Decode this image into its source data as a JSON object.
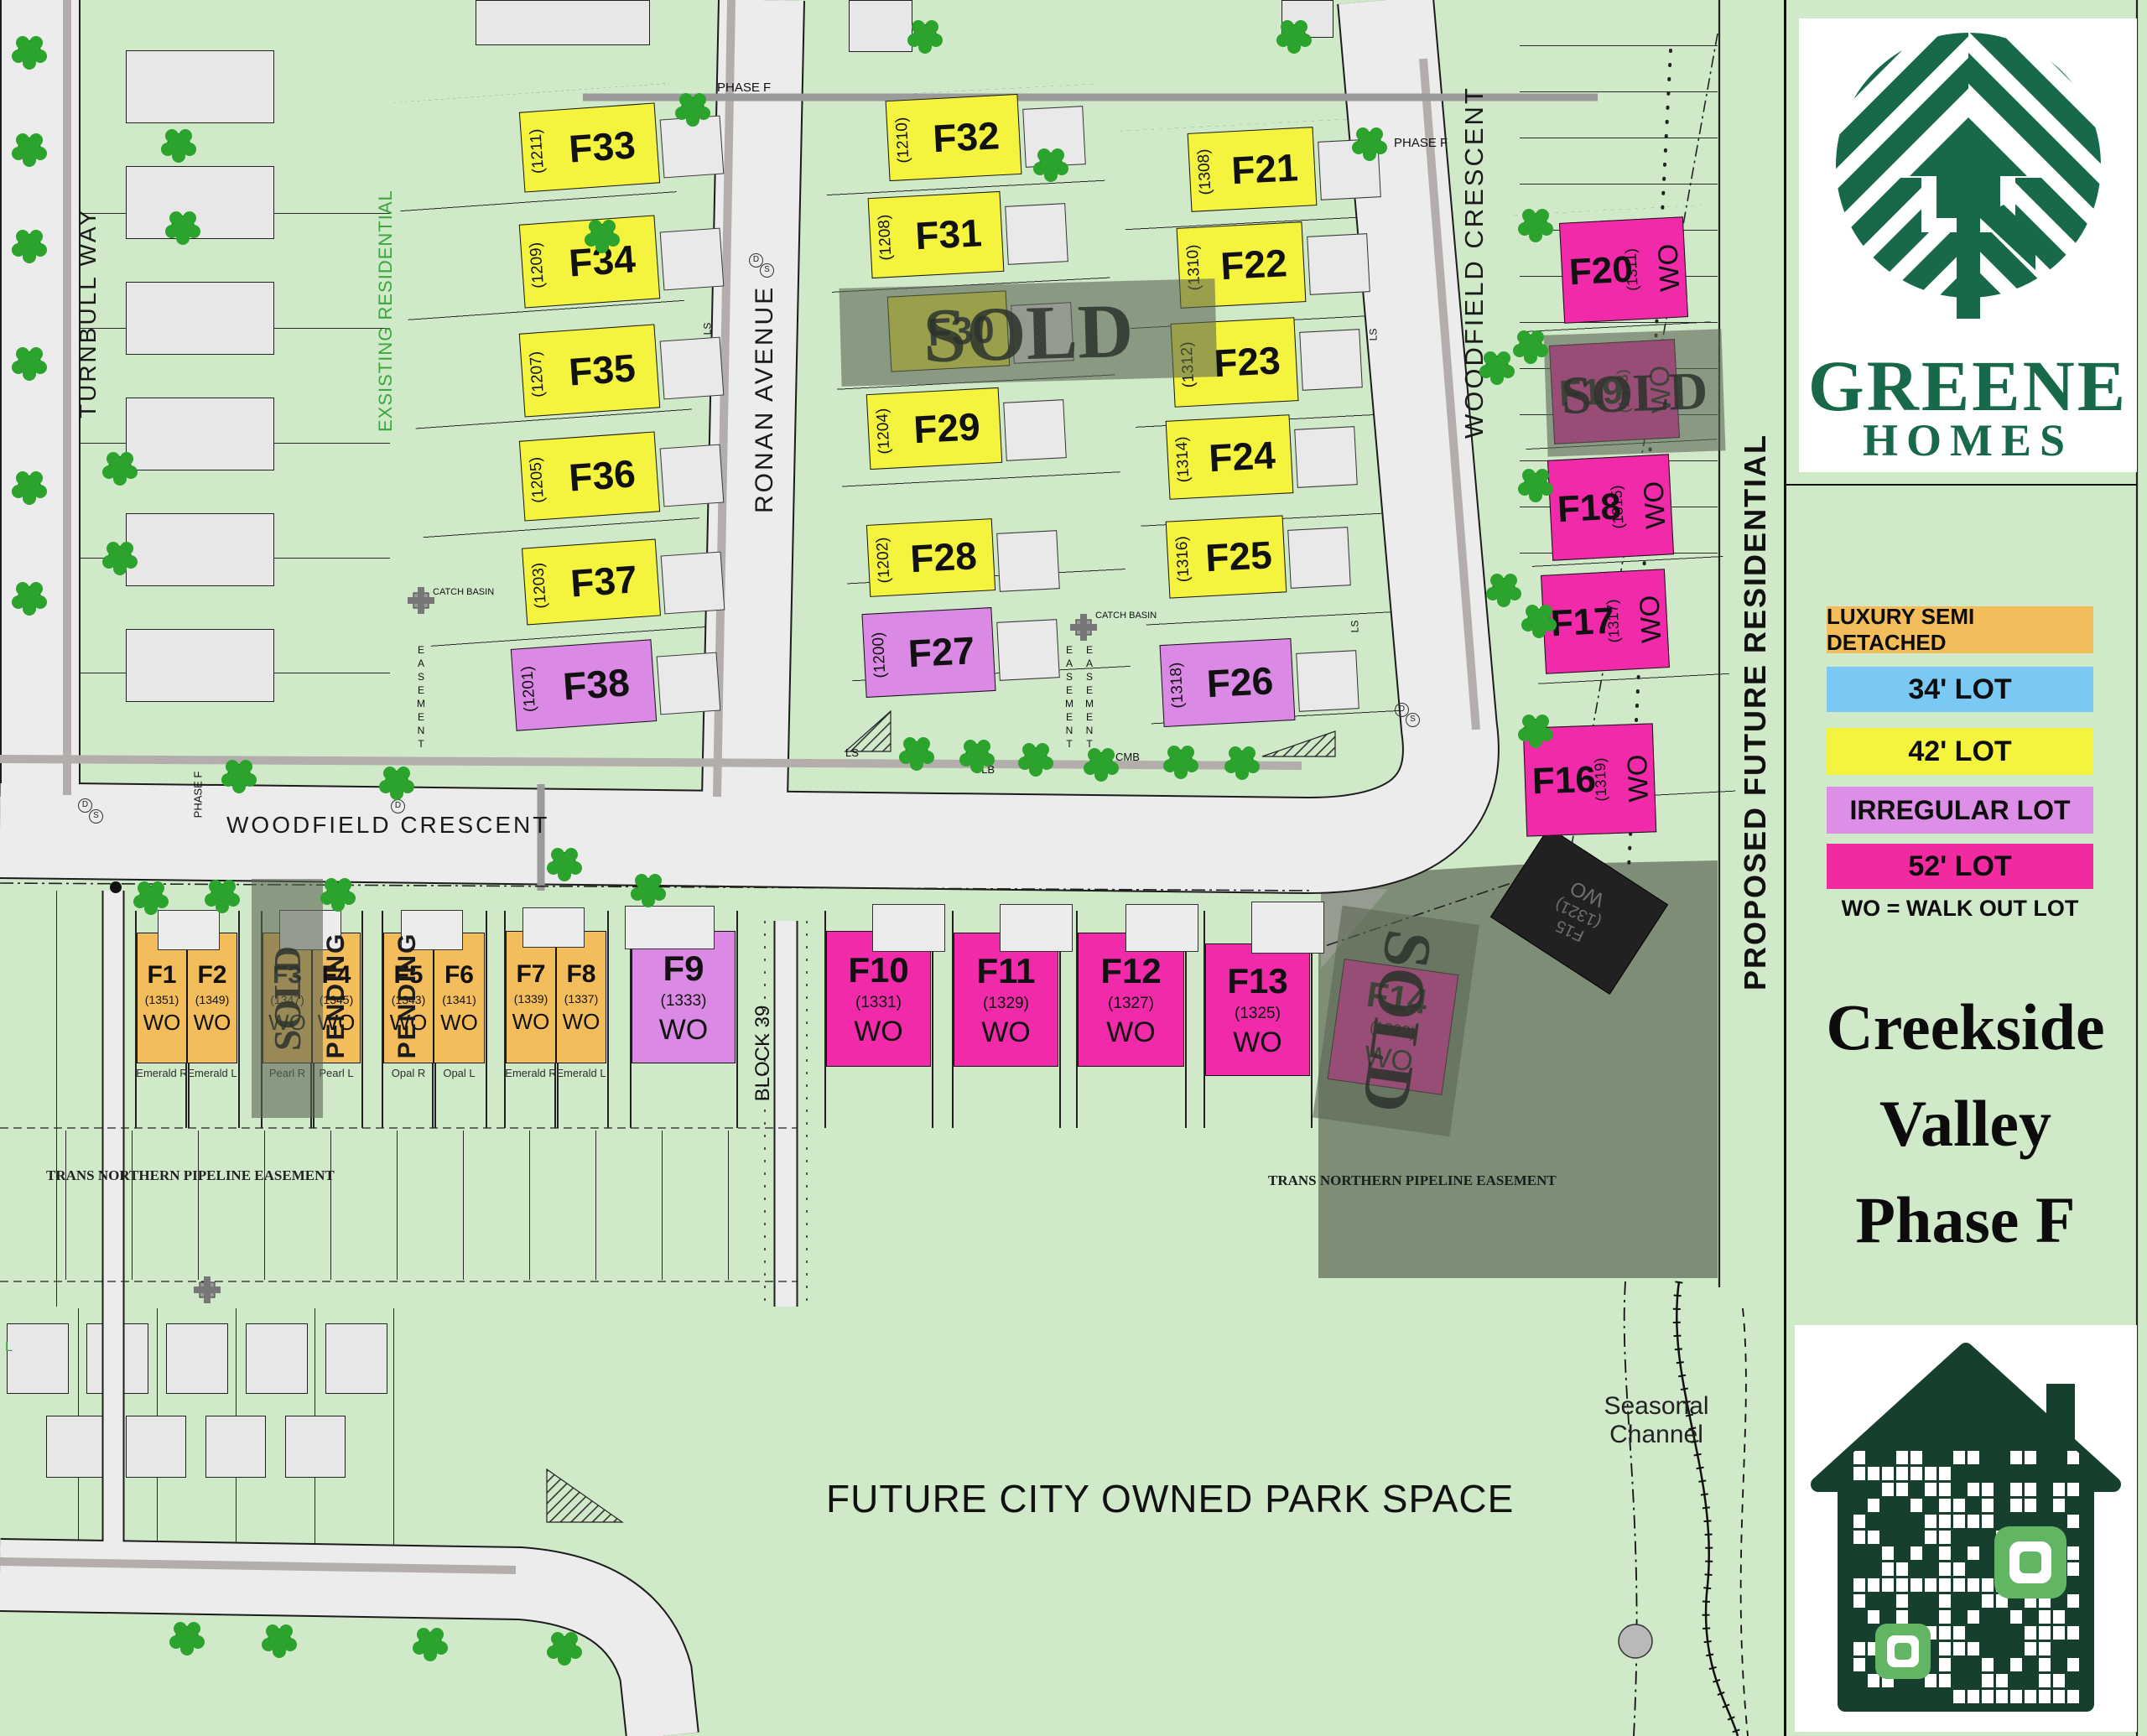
{
  "map": {
    "streets": {
      "turnbull": "TURNBULL WAY",
      "ronan": "RONAN AVENUE",
      "woodfield_bottom": "WOODFIELD CRESCENT",
      "woodfield_side": "WOODFIELD CRESCENT"
    },
    "labels": {
      "phase_f": "PHASE F",
      "existing": "EXSISTING RESIDENTIAL",
      "proposed": "PROPOSED FUTURE RESIDENTIAL",
      "block39": "BLOCK 39",
      "pipeline": "TRANS NORTHERN PIPELINE EASEMENT",
      "park": "FUTURE CITY OWNED PARK SPACE",
      "seasonal": "Seasonal\nChannel",
      "catch_basin": "CATCH BASIN",
      "easement": "EASEMENT",
      "sold": "SOLD",
      "pending": "PENDING",
      "ls": "LS",
      "glb": "GLB",
      "cmb": "CMB",
      "l": "L",
      "d": "D",
      "s": "S"
    }
  },
  "lots": [
    {
      "id": "F1",
      "label": "F1",
      "number": "(1351)",
      "type": "semi",
      "wo": "WO",
      "model": "Emerald R",
      "status": "available"
    },
    {
      "id": "F2",
      "label": "F2",
      "number": "(1349)",
      "type": "semi",
      "wo": "WO",
      "model": "Emerald L",
      "status": "available"
    },
    {
      "id": "F3",
      "label": "F3",
      "number": "(1347)",
      "type": "semi",
      "wo": "WO",
      "model": "Pearl R",
      "status": "sold"
    },
    {
      "id": "F4",
      "label": "F4",
      "number": "(1345)",
      "type": "semi",
      "wo": "WO",
      "model": "Pearl L",
      "status": "pending"
    },
    {
      "id": "F5",
      "label": "F5",
      "number": "(1343)",
      "type": "semi",
      "wo": "WO",
      "model": "Opal R",
      "status": "pending"
    },
    {
      "id": "F6",
      "label": "F6",
      "number": "(1341)",
      "type": "semi",
      "wo": "WO",
      "model": "Opal L",
      "status": "available"
    },
    {
      "id": "F7",
      "label": "F7",
      "number": "(1339)",
      "type": "semi",
      "wo": "WO",
      "model": "Emerald R",
      "status": "available"
    },
    {
      "id": "F8",
      "label": "F8",
      "number": "(1337)",
      "type": "semi",
      "wo": "WO",
      "model": "Emerald L",
      "status": "available"
    },
    {
      "id": "F9",
      "label": "F9",
      "number": "(1333)",
      "type": "irregular",
      "wo": "WO",
      "model": "",
      "status": "available"
    },
    {
      "id": "F10",
      "label": "F10",
      "number": "(1331)",
      "type": "52",
      "wo": "WO",
      "model": "",
      "status": "available"
    },
    {
      "id": "F11",
      "label": "F11",
      "number": "(1329)",
      "type": "52",
      "wo": "WO",
      "model": "",
      "status": "available"
    },
    {
      "id": "F12",
      "label": "F12",
      "number": "(1327)",
      "type": "52",
      "wo": "WO",
      "model": "",
      "status": "available"
    },
    {
      "id": "F13",
      "label": "F13",
      "number": "(1325)",
      "type": "52",
      "wo": "WO",
      "model": "",
      "status": "available"
    },
    {
      "id": "F14",
      "label": "F14",
      "number": "(1323)",
      "type": "52",
      "wo": "WO",
      "model": "",
      "status": "sold"
    },
    {
      "id": "F15",
      "label": "F15",
      "number": "(1321)",
      "type": "sold_dark",
      "wo": "WO",
      "model": "",
      "status": "sold"
    },
    {
      "id": "F16",
      "label": "F16",
      "number": "(1319)",
      "type": "52",
      "wo": "WO",
      "model": "",
      "status": "available"
    },
    {
      "id": "F17",
      "label": "F17",
      "number": "(1317)",
      "type": "52",
      "wo": "WO",
      "model": "",
      "status": "available"
    },
    {
      "id": "F18",
      "label": "F18",
      "number": "(1315)",
      "type": "52",
      "wo": "WO",
      "model": "",
      "status": "available"
    },
    {
      "id": "F19",
      "label": "F19",
      "number": "(1313)",
      "type": "52",
      "wo": "WO",
      "model": "",
      "status": "sold"
    },
    {
      "id": "F20",
      "label": "F20",
      "number": "(1311)",
      "type": "52",
      "wo": "WO",
      "model": "",
      "status": "available"
    },
    {
      "id": "F21",
      "label": "F21",
      "number": "(1308)",
      "type": "42",
      "wo": "",
      "model": "",
      "status": "available"
    },
    {
      "id": "F22",
      "label": "F22",
      "number": "(1310)",
      "type": "42",
      "wo": "",
      "model": "",
      "status": "available"
    },
    {
      "id": "F23",
      "label": "F23",
      "number": "(1312)",
      "type": "42",
      "wo": "",
      "model": "",
      "status": "available"
    },
    {
      "id": "F24",
      "label": "F24",
      "number": "(1314)",
      "type": "42",
      "wo": "",
      "model": "",
      "status": "available"
    },
    {
      "id": "F25",
      "label": "F25",
      "number": "(1316)",
      "type": "42",
      "wo": "",
      "model": "",
      "status": "available"
    },
    {
      "id": "F26",
      "label": "F26",
      "number": "(1318)",
      "type": "irregular",
      "wo": "",
      "model": "",
      "status": "available"
    },
    {
      "id": "F27",
      "label": "F27",
      "number": "(1200)",
      "type": "irregular",
      "wo": "",
      "model": "",
      "status": "available"
    },
    {
      "id": "F28",
      "label": "F28",
      "number": "(1202)",
      "type": "42",
      "wo": "",
      "model": "",
      "status": "available"
    },
    {
      "id": "F29",
      "label": "F29",
      "number": "(1204)",
      "type": "42",
      "wo": "",
      "model": "",
      "status": "available"
    },
    {
      "id": "F30",
      "label": "F30",
      "number": "",
      "type": "42",
      "wo": "",
      "model": "",
      "status": "sold"
    },
    {
      "id": "F31",
      "label": "F31",
      "number": "(1208)",
      "type": "42",
      "wo": "",
      "model": "",
      "status": "available"
    },
    {
      "id": "F32",
      "label": "F32",
      "number": "(1210)",
      "type": "42",
      "wo": "",
      "model": "",
      "status": "available"
    },
    {
      "id": "F33",
      "label": "F33",
      "number": "(1211)",
      "type": "42",
      "wo": "",
      "model": "",
      "status": "available"
    },
    {
      "id": "F34",
      "label": "F34",
      "number": "(1209)",
      "type": "42",
      "wo": "",
      "model": "",
      "status": "available"
    },
    {
      "id": "F35",
      "label": "F35",
      "number": "(1207)",
      "type": "42",
      "wo": "",
      "model": "",
      "status": "available"
    },
    {
      "id": "F36",
      "label": "F36",
      "number": "(1205)",
      "type": "42",
      "wo": "",
      "model": "",
      "status": "available"
    },
    {
      "id": "F37",
      "label": "F37",
      "number": "(1203)",
      "type": "42",
      "wo": "",
      "model": "",
      "status": "available"
    },
    {
      "id": "F38",
      "label": "F38",
      "number": "(1201)",
      "type": "irregular",
      "wo": "",
      "model": "",
      "status": "available"
    }
  ],
  "legend": {
    "items": [
      {
        "label": "LUXURY SEMI DETACHED",
        "color": "#f3bd5c"
      },
      {
        "label": "34' LOT",
        "color": "#7ac9f5"
      },
      {
        "label": "42' LOT",
        "color": "#f4f43e"
      },
      {
        "label": "IRREGULAR LOT",
        "color": "#dd8fe8"
      },
      {
        "label": "52' LOT",
        "color": "#f22aa0"
      }
    ],
    "note": "WO = WALK OUT LOT"
  },
  "sidebar": {
    "brand_line1": "GREENE",
    "brand_line2": "HOMES",
    "title_line1": "Creekside",
    "title_line2": "Valley",
    "title_line3": "Phase F"
  },
  "colors": {
    "map_bg": "#cfe9c9",
    "street": "#ececec",
    "sidewalk": "#b3aeab",
    "yellow": "#f4f43e",
    "purple": "#da8ae4",
    "magenta": "#f02aa8",
    "orange": "#f3bd5c",
    "blue": "#7ac9f5",
    "tree": "#2ba32c",
    "logo_green": "#17694a",
    "dark_zone": "#7e8e76"
  }
}
